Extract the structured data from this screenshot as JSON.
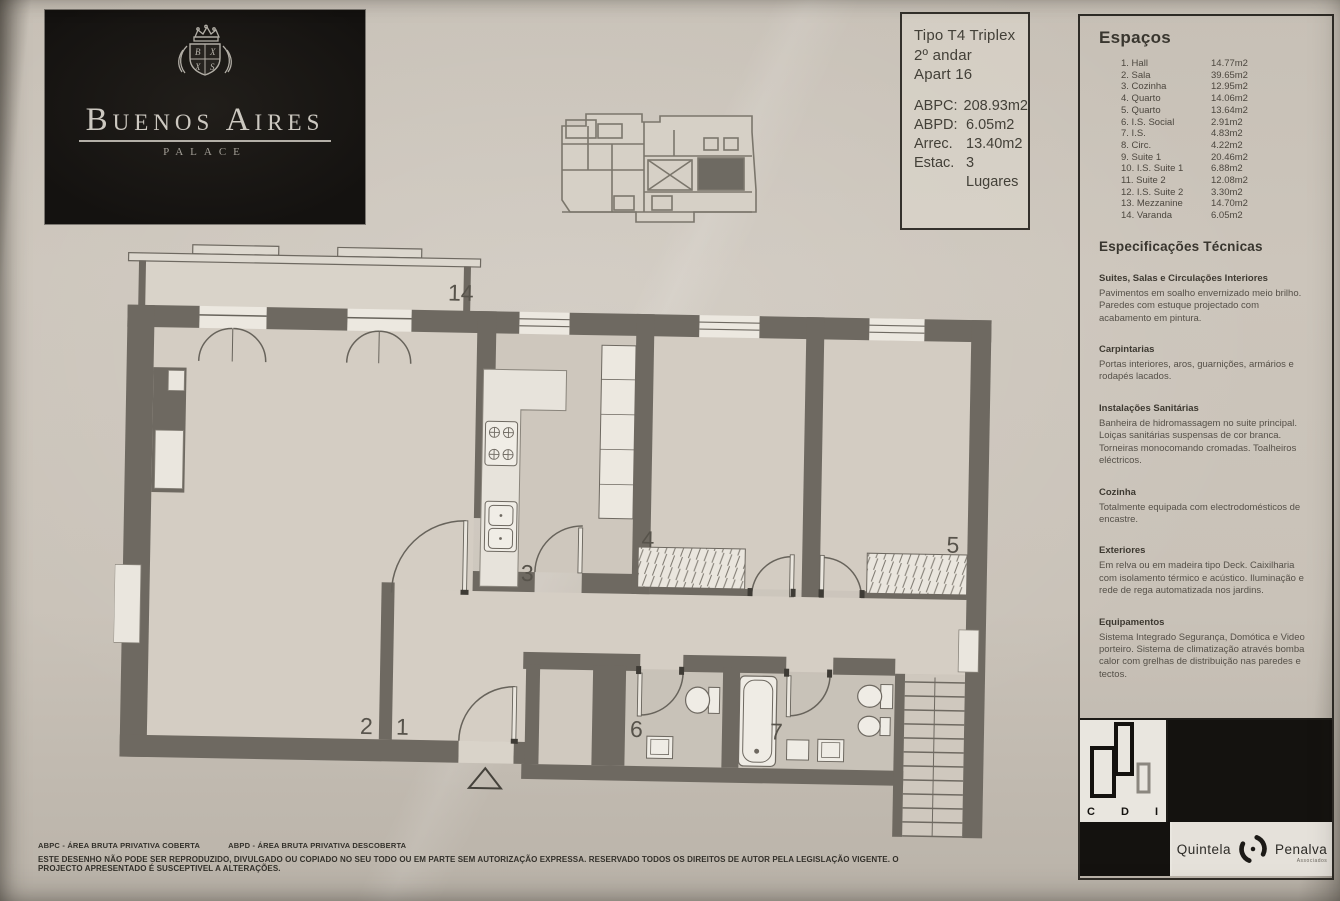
{
  "colors": {
    "paper": "#cbc4ba",
    "wall": "#6e6961",
    "ink": "#3b3833",
    "plan_text": "#57534b"
  },
  "brand": {
    "name": "Buenos Aires",
    "subtitle": "PALACE"
  },
  "title_block": {
    "type": "Tipo T4 Triplex",
    "floor": "2º andar",
    "unit": "Apart 16",
    "stats": [
      {
        "label": "ABPC:",
        "value": "208.93m2"
      },
      {
        "label": "ABPD:",
        "value": "6.05m2"
      },
      {
        "label": "Arrec.",
        "value": "13.40m2"
      },
      {
        "label": "Estac.",
        "value": "3 Lugares"
      }
    ]
  },
  "spaces": {
    "title": "Espaços",
    "rows": [
      {
        "name": "1. Hall",
        "area": "14.77m2"
      },
      {
        "name": "2. Sala",
        "area": "39.65m2"
      },
      {
        "name": "3. Cozinha",
        "area": "12.95m2"
      },
      {
        "name": "4. Quarto",
        "area": "14.06m2"
      },
      {
        "name": "5. Quarto",
        "area": "13.64m2"
      },
      {
        "name": "6. I.S. Social",
        "area": "2.91m2"
      },
      {
        "name": "7. I.S.",
        "area": "4.83m2"
      },
      {
        "name": "8. Circ.",
        "area": "4.22m2"
      },
      {
        "name": "9. Suite 1",
        "area": "20.46m2"
      },
      {
        "name": "10. I.S. Suite 1",
        "area": "6.88m2"
      },
      {
        "name": "11. Suite 2",
        "area": "12.08m2"
      },
      {
        "name": "12. I.S. Suite 2",
        "area": "3.30m2"
      },
      {
        "name": "13. Mezzanine",
        "area": "14.70m2"
      },
      {
        "name": "14. Varanda",
        "area": "6.05m2"
      }
    ]
  },
  "specs": {
    "title": "Especificações Técnicas",
    "sections": [
      {
        "heading": "Suites, Salas e Circulações Interiores",
        "body": "Pavimentos em soalho envernizado meio brilho. Paredes com estuque projectado com acabamento em pintura."
      },
      {
        "heading": "Carpintarias",
        "body": "Portas interiores, aros, guarnições, armários e rodapés lacados."
      },
      {
        "heading": "Instalações Sanitárias",
        "body": "Banheira de hidromassagem no suite principal. Loiças sanitárias suspensas de cor branca. Torneiras monocomando cromadas. Toalheiros eléctricos."
      },
      {
        "heading": "Cozinha",
        "body": "Totalmente equipada com electrodomésticos de encastre."
      },
      {
        "heading": "Exteriores",
        "body": "Em relva ou em madeira tipo Deck. Caixilharia com isolamento térmico e acústico. Iluminação e rede de rega automatizada nos jardins."
      },
      {
        "heading": "Equipamentos",
        "body": "Sistema Integrado Segurança, Domótica e Video porteiro. Sistema de climatização através bomba calor com grelhas de distribuição nas paredes e tectos."
      }
    ]
  },
  "plan": {
    "labels": [
      {
        "t": "14",
        "x": 328,
        "y": 55
      },
      {
        "t": "2",
        "x": 248,
        "y": 490
      },
      {
        "t": "1",
        "x": 284,
        "y": 490
      },
      {
        "t": "3",
        "x": 406,
        "y": 334
      },
      {
        "t": "4",
        "x": 526,
        "y": 298
      },
      {
        "t": "5",
        "x": 831,
        "y": 298
      },
      {
        "t": "6",
        "x": 518,
        "y": 488
      },
      {
        "t": "7",
        "x": 658,
        "y": 488
      }
    ]
  },
  "partners": {
    "cdi_letters": [
      "C",
      "D",
      "I"
    ],
    "name_left": "Quintela",
    "name_right": "Penalva",
    "name_sub": "Associados"
  },
  "footer": {
    "legend_abpc": "ABPC - ÁREA BRUTA PRIVATIVA COBERTA",
    "legend_abpd": "ABPD - ÁREA BRUTA PRIVATIVA DESCOBERTA",
    "disclaimer": "ESTE DESENHO NÃO PODE SER REPRODUZIDO, DIVULGADO OU COPIADO NO SEU TODO OU EM PARTE SEM AUTORIZAÇÃO EXPRESSA. RESERVADO TODOS OS DIREITOS DE AUTOR PELA LEGISLAÇÃO VIGENTE. O PROJECTO APRESENTADO É SUSCEPTIVEL A ALTERAÇÕES."
  }
}
